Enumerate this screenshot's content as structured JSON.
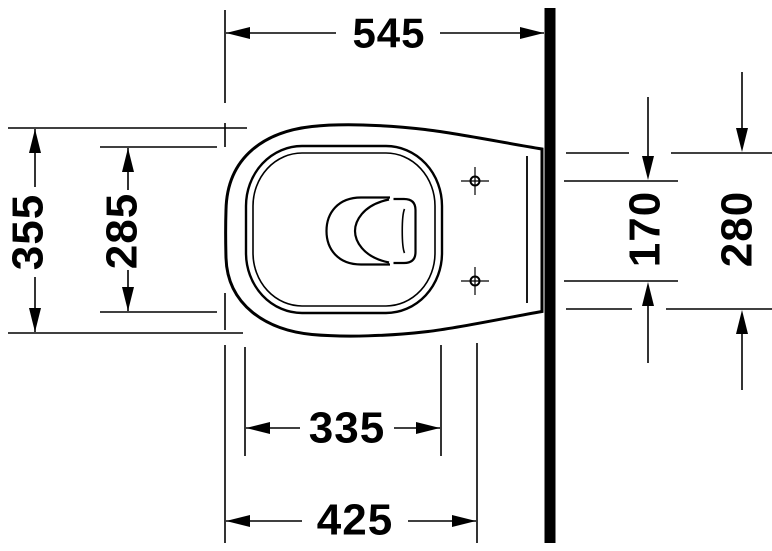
{
  "drawing": {
    "type": "toilet-top-view-dimension-drawing",
    "dimensions": {
      "overall_depth": "545",
      "overall_width": "355",
      "bowl_inner_width": "285",
      "fixing_hole_spacing": "170",
      "rear_width": "280",
      "bowl_inner_depth": "335",
      "front_to_fixing_holes": "425"
    },
    "colors": {
      "line": "#000000",
      "wall": "#000000",
      "background": "#ffffff"
    }
  }
}
